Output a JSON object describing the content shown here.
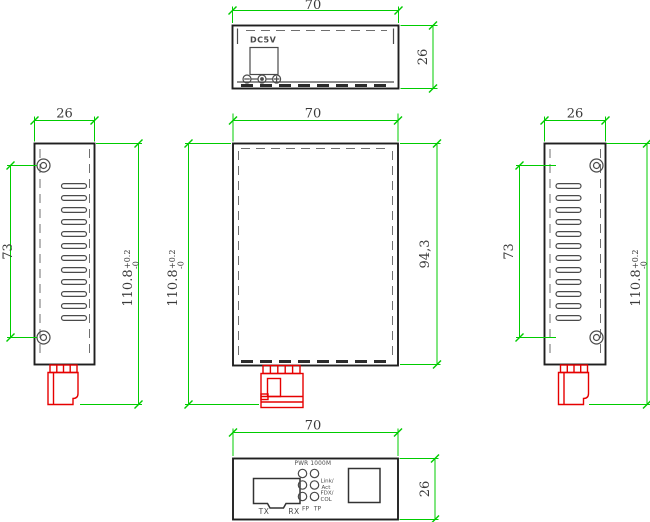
{
  "colors": {
    "dimension_green": "#00cc00",
    "connector_red": "#e60000",
    "body_outline": "#1f1f1f",
    "dimension_text": "#3a3a3a"
  },
  "views": {
    "top": {
      "dim_width": "70",
      "dim_depth": "26",
      "jack_label": "DC5V"
    },
    "left_side": {
      "dim_width": "26",
      "dim_hole_spacing": "73",
      "dim_height": "110.8",
      "tol_up": "+0.2",
      "tol_dn": "-0"
    },
    "main": {
      "dim_width": "70",
      "dim_height": "110.8",
      "tol_up": "+0.2",
      "tol_dn": "-0",
      "dim_body_height": "94,3"
    },
    "right_side": {
      "dim_width": "26",
      "dim_hole_spacing": "73",
      "dim_height": "110.8",
      "tol_up": "+0.2",
      "tol_dn": "-0"
    },
    "front_panel": {
      "dim_width": "70",
      "dim_depth": "26",
      "led_header": "PWR 1000M",
      "led_link": "Link/",
      "led_act": "Act",
      "led_fdx": "FDX/",
      "led_col": "COL",
      "label_fp": "FP",
      "label_tp": "TP",
      "label_tx": "TX",
      "label_rx": "RX"
    }
  }
}
